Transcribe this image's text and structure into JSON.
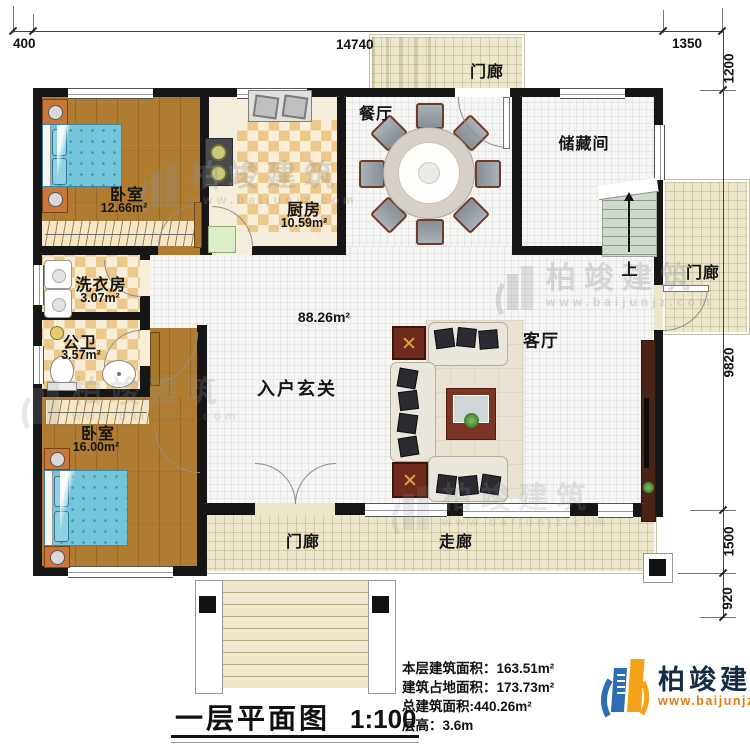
{
  "dims": {
    "top": [
      "400",
      "14740",
      "1350"
    ],
    "right": [
      "1200",
      "9820",
      "1500",
      "920"
    ]
  },
  "rooms": {
    "bedroom1": {
      "label": "卧室",
      "area": "12.66m²"
    },
    "kitchen": {
      "label": "厨房",
      "area": "10.59m²"
    },
    "dining": {
      "label": "餐厅"
    },
    "storage": {
      "label": "储藏间"
    },
    "stairs_up": {
      "label": "上"
    },
    "porch_top": {
      "label": "门廊"
    },
    "porch_right": {
      "label": "门廊"
    },
    "porch_bottom": {
      "label": "门廊"
    },
    "corridor": {
      "label": "走廊"
    },
    "laundry": {
      "label": "洗衣房",
      "area": "3.07m²"
    },
    "bath": {
      "label": "公卫",
      "area": "3.57m²"
    },
    "bedroom2": {
      "label": "卧室",
      "area": "16.00m²"
    },
    "foyer": {
      "label": "入户玄关"
    },
    "open_area": {
      "area": "88.26m²"
    },
    "living": {
      "label": "客厅"
    }
  },
  "titleblock": {
    "title": "一层平面图",
    "scale": "1:100"
  },
  "info": {
    "floor_area_label": "本层建筑面积：",
    "floor_area_value": "163.51m²",
    "footprint_label": "建筑占地面积：",
    "footprint_value": "173.73m²",
    "total_area_label": "总建筑面积:",
    "total_area_value": "440.26m²",
    "height_label": "层高：",
    "height_value": "3.6m"
  },
  "logo": {
    "name": "柏竣建筑",
    "site": "www.baijunjz.com"
  },
  "watermark": {
    "name": "柏竣建筑",
    "site": "www.baijunjz.com"
  },
  "colors": {
    "wall": "#161616",
    "wood_floor": "#b07c31",
    "tile_tan": "#ecc98b",
    "porch": "#ece6cb",
    "bed": "#74c4da",
    "logo_blue": "#2e6db4",
    "logo_orange": "#f5a21b",
    "logo_text": "#152a44",
    "logo_site": "#e07b16"
  }
}
